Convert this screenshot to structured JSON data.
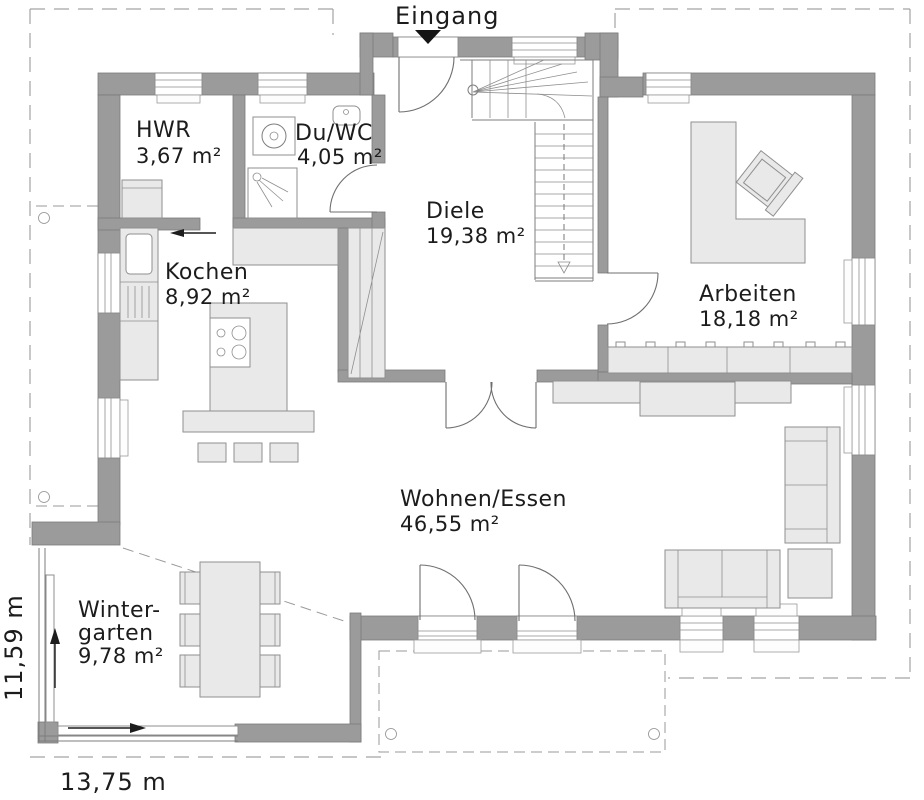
{
  "entrance": {
    "label": "Eingang"
  },
  "rooms": [
    {
      "name": "HWR",
      "area": "3,67 m²"
    },
    {
      "name": "Du/WC",
      "area": "4,05 m²"
    },
    {
      "name": "Diele",
      "area": "19,38 m²"
    },
    {
      "name": "Kochen",
      "area": "8,92 m²"
    },
    {
      "name": "Arbeiten",
      "area": "18,18 m²"
    },
    {
      "name": "Wohnen/Essen",
      "area": "46,55 m²"
    },
    {
      "name_line1": "Winter-",
      "name_line2": "garten",
      "area": "9,78 m²"
    }
  ],
  "dimensions": {
    "width_label": "13,75 m",
    "height_label": "11,59 m"
  },
  "colors": {
    "wall": "#9b9b9b",
    "furniture": "#e9e9e9",
    "text": "#1c1c1c",
    "entrance_marker": "#141414",
    "dashed_outline": "#a3a3a3"
  }
}
